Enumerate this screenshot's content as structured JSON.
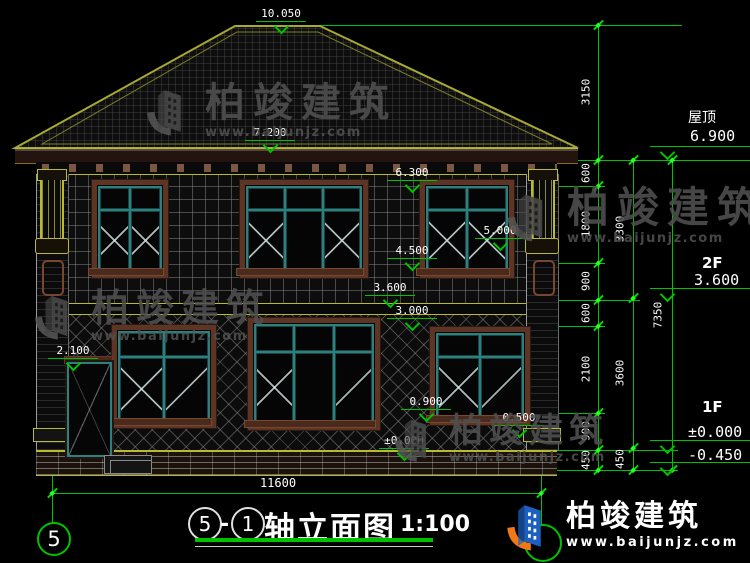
{
  "drawing": {
    "scale_label": "1:100",
    "title_text": "轴立面图",
    "axis_from": "5",
    "axis_sep": "-",
    "axis_to": "1",
    "axis_bubble_left": "5"
  },
  "levels_inline": [
    "10.050",
    "7.200",
    "6.300",
    "5.000",
    "4.500",
    "3.600",
    "3.000",
    "2.100",
    "0.900",
    "0.500",
    "±0.000"
  ],
  "levels_right": [
    {
      "name": "屋顶",
      "value": "6.900"
    },
    {
      "name": "2F",
      "value": "3.600"
    },
    {
      "name": "1F",
      "value": "±0.000"
    },
    {
      "name": "",
      "value": "-0.450"
    }
  ],
  "dims": {
    "chain_inner": [
      "3150",
      "600",
      "1800",
      "900",
      "600",
      "2100",
      "900",
      "450"
    ],
    "chain_mid": [
      "3300",
      "3600",
      "450"
    ],
    "chain_outer": [
      "7350"
    ],
    "bottom": "11600"
  },
  "brand": {
    "name": "柏竣建筑",
    "url": "www.baijunjz.com"
  },
  "colors": {
    "dim_green": "#00c300",
    "trim_yellow": "#b9b932",
    "frame_brown": "#5e3424",
    "sash_teal": "#2f7f7f",
    "logo_blue": "#1d5fc0",
    "logo_orange": "#f07818"
  }
}
